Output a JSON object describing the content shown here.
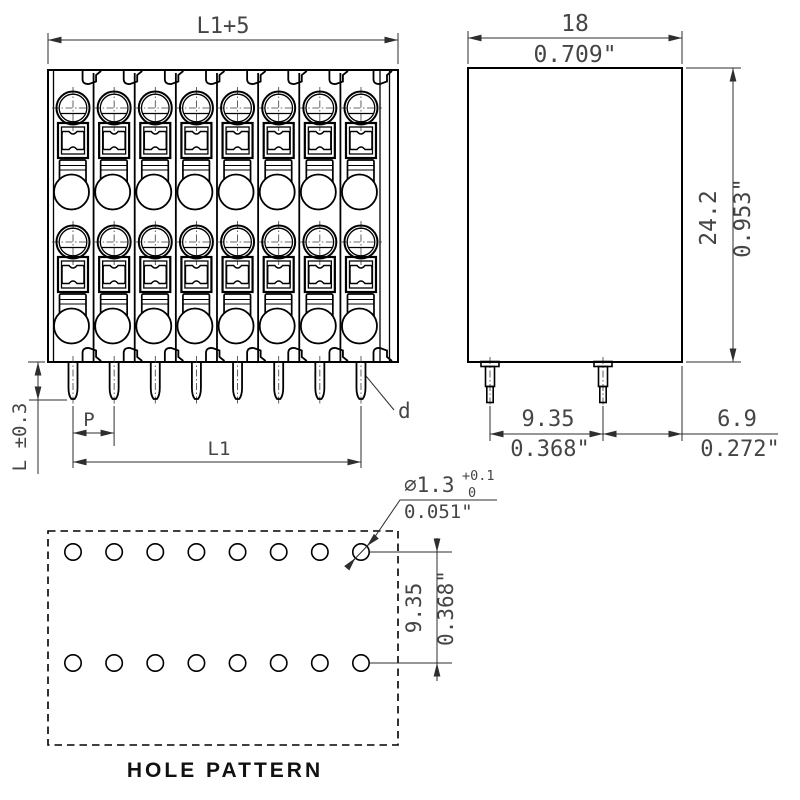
{
  "drawing": {
    "front_view": {
      "positions": 8,
      "dim_overall_width": "L1+5",
      "dim_pin_length": "L ±0.3",
      "dim_pitch": "P",
      "dim_pin_span": "L1",
      "pin_diameter_label": "d"
    },
    "side_view": {
      "pins": 2,
      "dim_depth_mm": "18",
      "dim_depth_inch": "0.709\"",
      "dim_height_mm": "24.2",
      "dim_height_inch": "0.953\"",
      "dim_pin_spacing_mm": "9.35",
      "dim_pin_spacing_inch": "0.368\"",
      "dim_pin_to_edge_mm": "6.9",
      "dim_pin_to_edge_inch": "0.272\""
    },
    "hole_pattern": {
      "label": "HOLE PATTERN",
      "holes_per_row": 8,
      "rows": 2,
      "hole_diameter_mm": "⌀1.3",
      "tolerance_plus": "+0.1",
      "tolerance_minus": "0",
      "hole_diameter_inch": "0.051\"",
      "row_spacing_mm": "9.35",
      "row_spacing_inch": "0.368\""
    },
    "colors": {
      "line": "#000000",
      "dimension": "#2e2e2e",
      "background": "#ffffff"
    }
  }
}
